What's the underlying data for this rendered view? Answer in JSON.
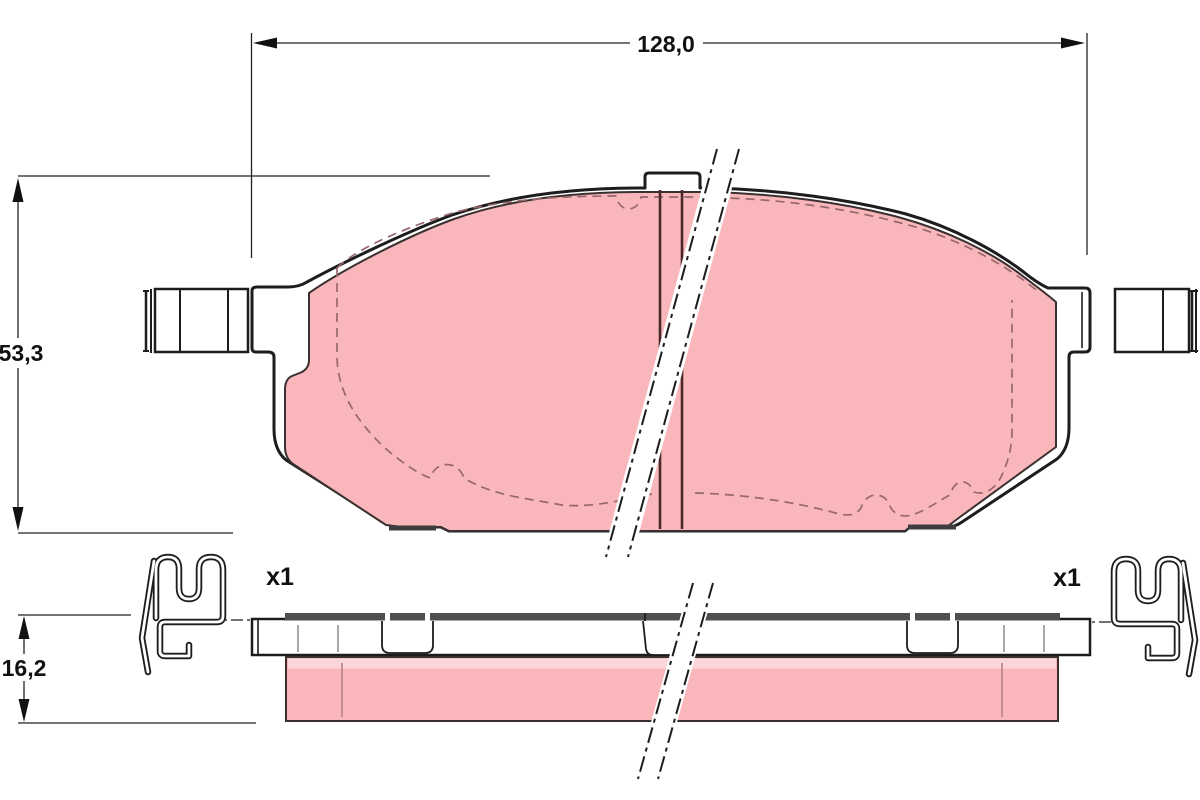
{
  "dimensions": {
    "width": "128,0",
    "height": "53,3",
    "thickness": "16,2"
  },
  "clips": {
    "left_qty": "x1",
    "right_qty": "x1"
  },
  "colors": {
    "friction": "#f9b7bb",
    "friction_light": "#fcd7d9",
    "outline": "#1d1d1d",
    "shim": "#4f4f4f",
    "slot": "#4a2828",
    "hidden": "#96686c",
    "background": "#ffffff"
  }
}
